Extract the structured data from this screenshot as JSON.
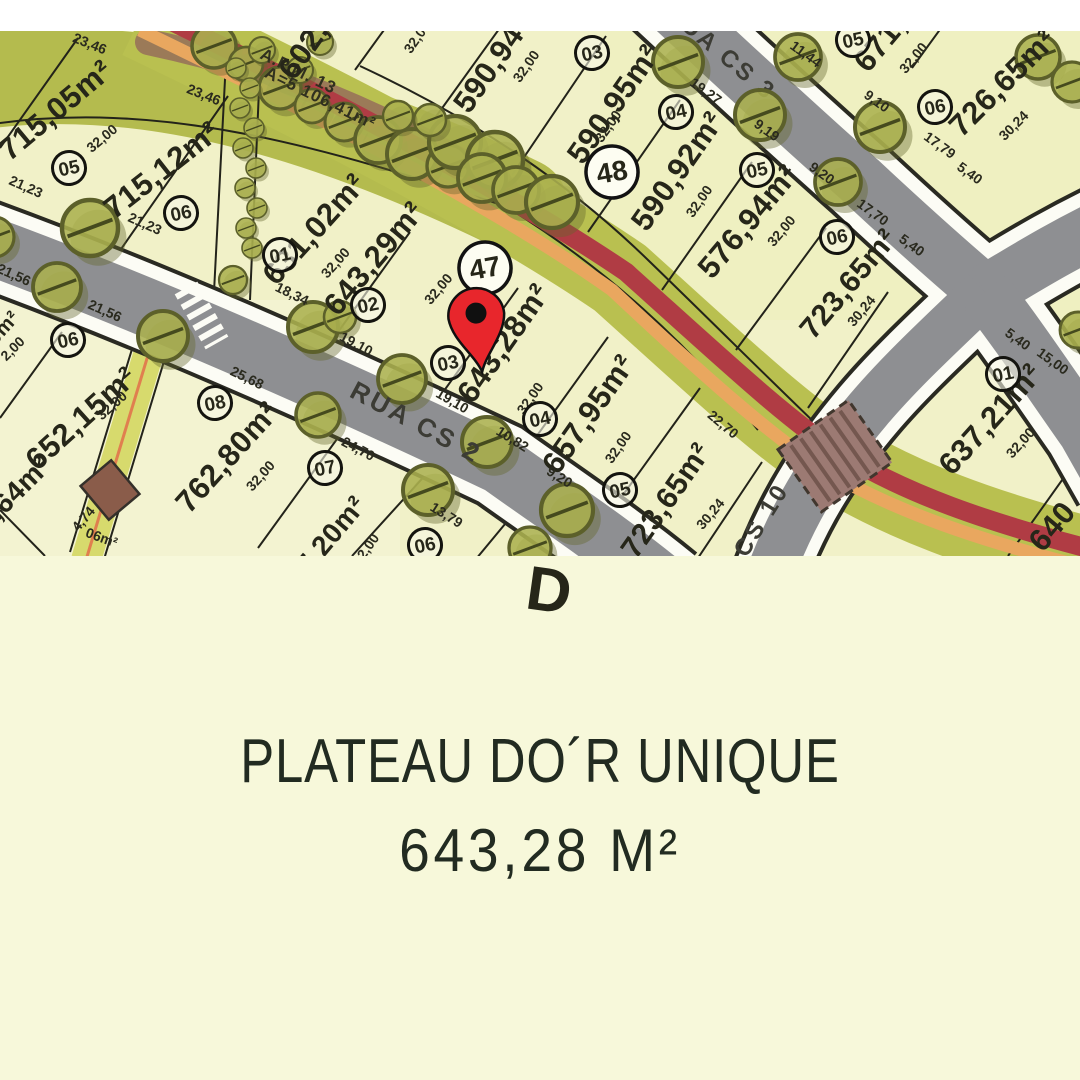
{
  "footer": {
    "title": "PLATEAU DO´R UNIQUE",
    "area": "643,28 M²"
  },
  "map": {
    "streets": [
      "RUA CS 2",
      "RUA CS 3",
      "CS 10"
    ],
    "apm": [
      "A.P.M. 13",
      "A=5 106,41m²"
    ],
    "block_markers": [
      "47",
      "48"
    ],
    "lot_markers": [
      "05",
      "06",
      "01",
      "02",
      "03",
      "04",
      "05",
      "06",
      "06",
      "08",
      "07",
      "03",
      "04",
      "05",
      "06",
      "05",
      "06",
      "01"
    ],
    "areas": [
      "715,05m²",
      "715,12m²",
      "631,02m²",
      "643,29m²",
      "643,28m²",
      "657,95m²",
      "723,65m²",
      "602,",
      "590,94",
      "590,95m²",
      "590,92m²",
      "576,94m²",
      "723,65m²",
      "726,65m²",
      "671,",
      "637,21m²",
      "640",
      "652,15m²",
      "762,80m²",
      "7,20m²",
      "6,64m²",
      "0m²"
    ],
    "dims": [
      "23,46",
      "23,46",
      "21,23",
      "21,23",
      "21,56",
      "21,56",
      "25,68",
      "24,70",
      "19,10",
      "19,10",
      "18,34",
      "10,82",
      "9,20",
      "13,79",
      "2,00",
      "30,24",
      "30,24",
      "30,24",
      "11,44",
      "9,10",
      "19,27",
      "17,79",
      "5,40",
      "17,70",
      "5,40",
      "22,70",
      "5,40",
      "15,00",
      "4,74",
      "06m²",
      "32,00",
      "32,00",
      "32,00",
      "32,00",
      "32,00",
      "32,00",
      "32,00",
      "32,00",
      "32,00",
      "32,00",
      "32,00",
      "32,00",
      "32,00",
      "9,19",
      "9,20",
      "32,00",
      "2,00"
    ],
    "watermark": "D",
    "colors": {
      "pin": "#e8262c",
      "lot_fill": "#f1f1c8",
      "road": "#8e8f92",
      "verge_green": "#b7bf52",
      "bike_red": "#b03c44",
      "bike_orange": "#e9a75f",
      "footer_bg": "#f7f8da",
      "text": "#222b21"
    }
  }
}
